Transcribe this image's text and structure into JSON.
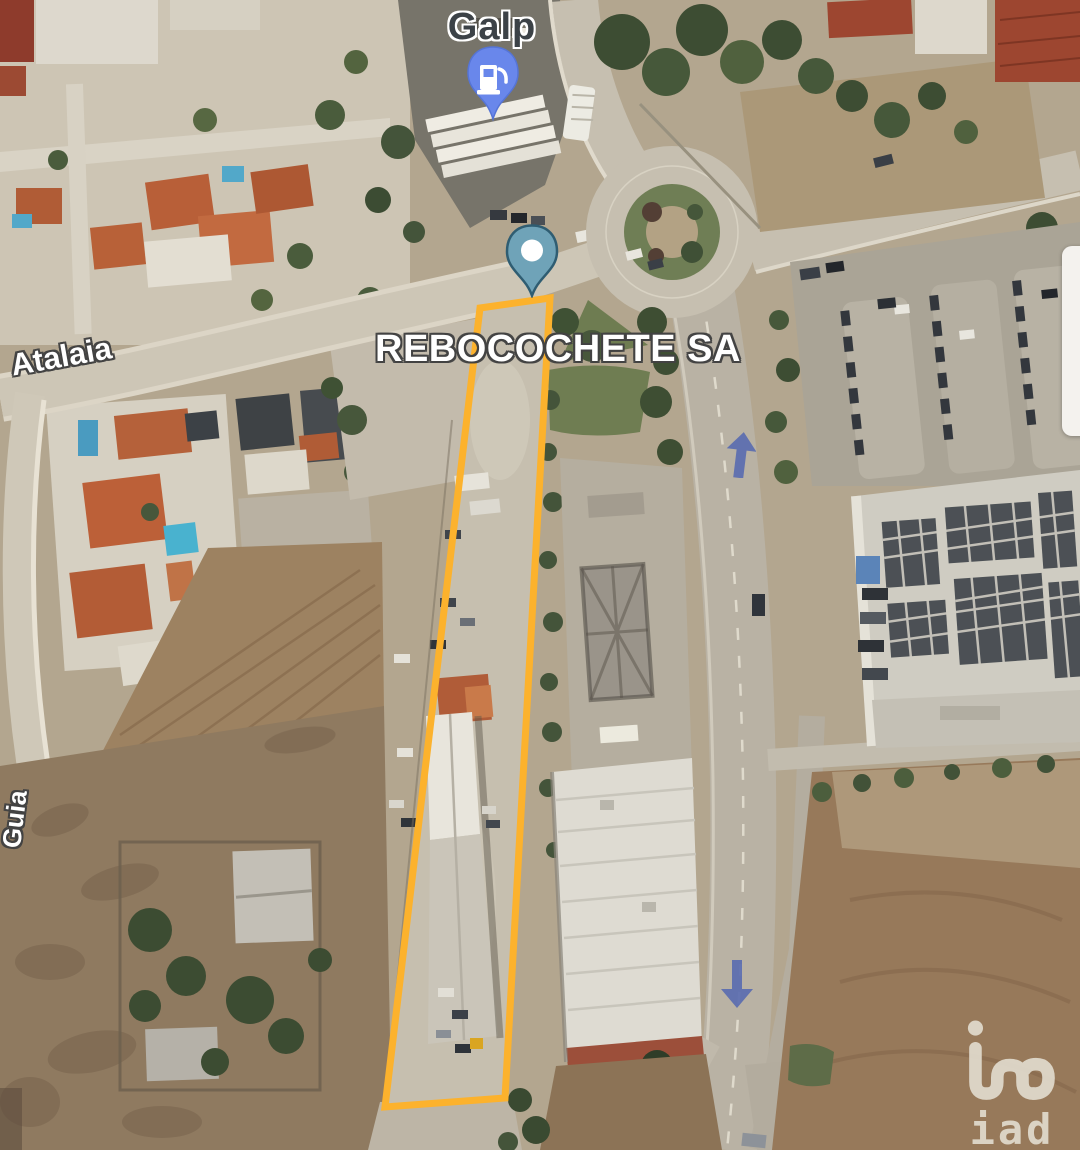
{
  "map": {
    "labels": {
      "gas_station": "Galp",
      "property": "REBOCOCHETE SA",
      "road_left": "Atalaia",
      "road_bottom_left": "Guia"
    },
    "watermark": {
      "brand": "iad"
    },
    "markers": {
      "gas_pin": {
        "icon": "fuel-pump-pin-icon",
        "color": "#6987eb"
      },
      "property_pin": {
        "icon": "location-pin-icon",
        "color": "#6fa3b8"
      }
    },
    "overlay": {
      "boundary_color": "#fcb22d",
      "arrow_color": "#5a6cb0",
      "one_way_arrows": [
        "up",
        "down"
      ]
    }
  }
}
